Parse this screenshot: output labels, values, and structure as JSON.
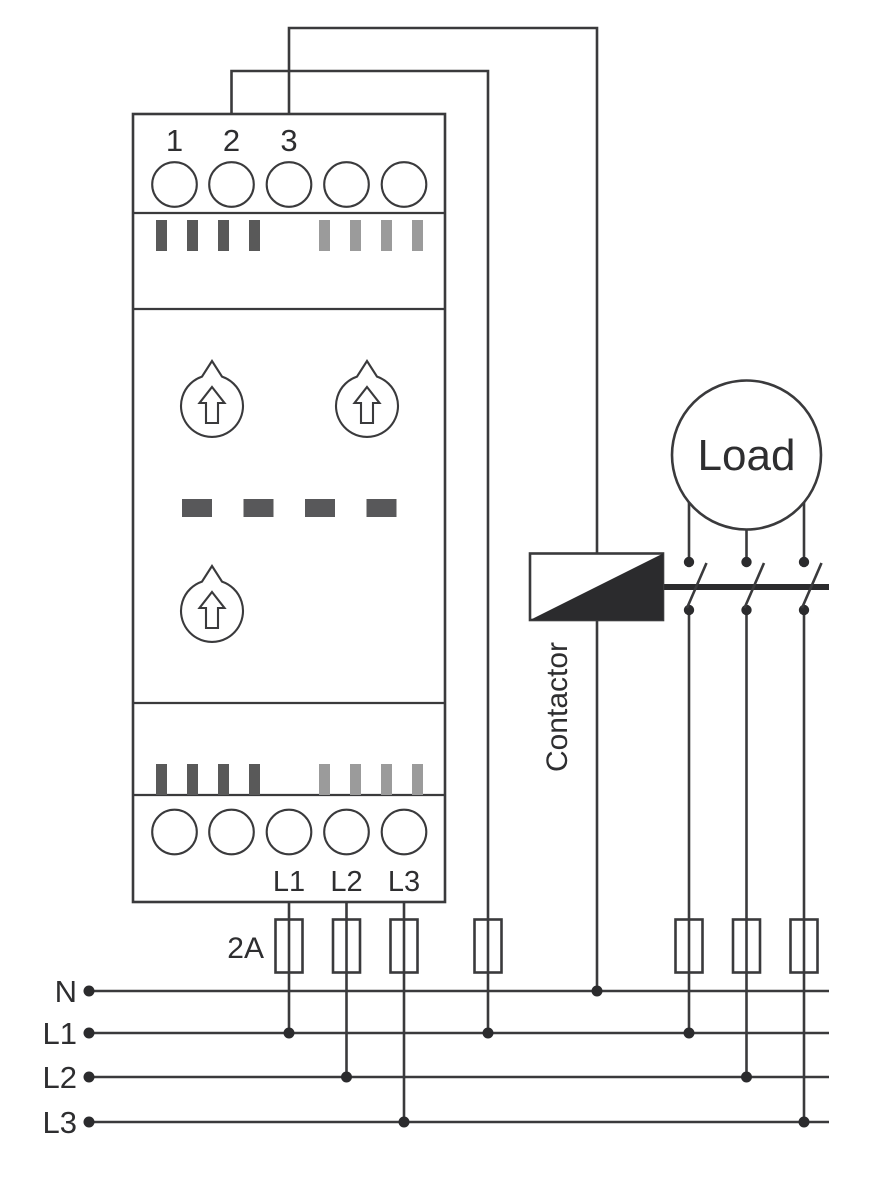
{
  "colors": {
    "line": "#3a3a3c",
    "dark": "#2b2b2d",
    "text": "#2e2e30",
    "slotDark": "#595959",
    "slotLight": "#9b9b9b",
    "dash": "#58585a",
    "bg": "#ffffff"
  },
  "device": {
    "top_terminal_labels": [
      "1",
      "2",
      "3"
    ],
    "bottom_terminal_labels": [
      "L1",
      "L2",
      "L3"
    ]
  },
  "labels": {
    "load": "Load",
    "contactor": "Contactor",
    "fuse_rating": "2A"
  },
  "bus": {
    "labels": [
      "N",
      "L1",
      "L2",
      "L3"
    ]
  }
}
